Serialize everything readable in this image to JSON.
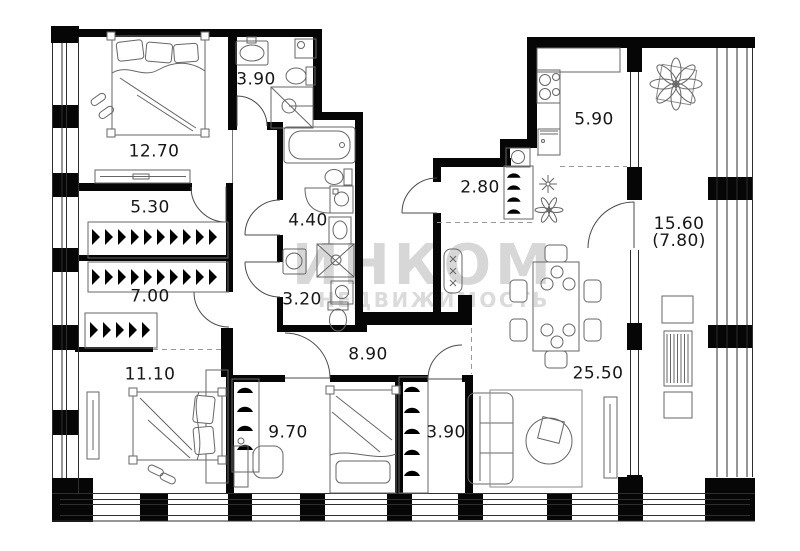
{
  "watermark": {
    "line1": "ИНКОМ",
    "line2": "НЕДВИЖИМОСТЬ"
  },
  "rooms": [
    {
      "name": "bedroom-1",
      "label": "12.70",
      "x": 154,
      "y": 152
    },
    {
      "name": "bathroom-1",
      "label": "3.90",
      "x": 256,
      "y": 80
    },
    {
      "name": "closet-1",
      "label": "5.30",
      "x": 150,
      "y": 208
    },
    {
      "name": "bathroom-2",
      "label": "4.40",
      "x": 308,
      "y": 221
    },
    {
      "name": "closet-2",
      "label": "7.00",
      "x": 150,
      "y": 297
    },
    {
      "name": "bathroom-3",
      "label": "3.20",
      "x": 302,
      "y": 300
    },
    {
      "name": "hallway",
      "label": "8.90",
      "x": 368,
      "y": 355
    },
    {
      "name": "entry-hall",
      "label": "2.80",
      "x": 480,
      "y": 188
    },
    {
      "name": "kitchen",
      "label": "5.90",
      "x": 594,
      "y": 120
    },
    {
      "name": "living-room",
      "label": "25.50",
      "x": 598,
      "y": 374
    },
    {
      "name": "bedroom-2",
      "label": "11.10",
      "x": 150,
      "y": 375
    },
    {
      "name": "bedroom-3",
      "label": "9.70",
      "x": 288,
      "y": 433
    },
    {
      "name": "closet-3",
      "label": "3.90",
      "x": 446,
      "y": 433
    },
    {
      "name": "balcony",
      "label": "15.60",
      "sublabel": "(7.80)",
      "x": 679,
      "y": 233
    }
  ]
}
